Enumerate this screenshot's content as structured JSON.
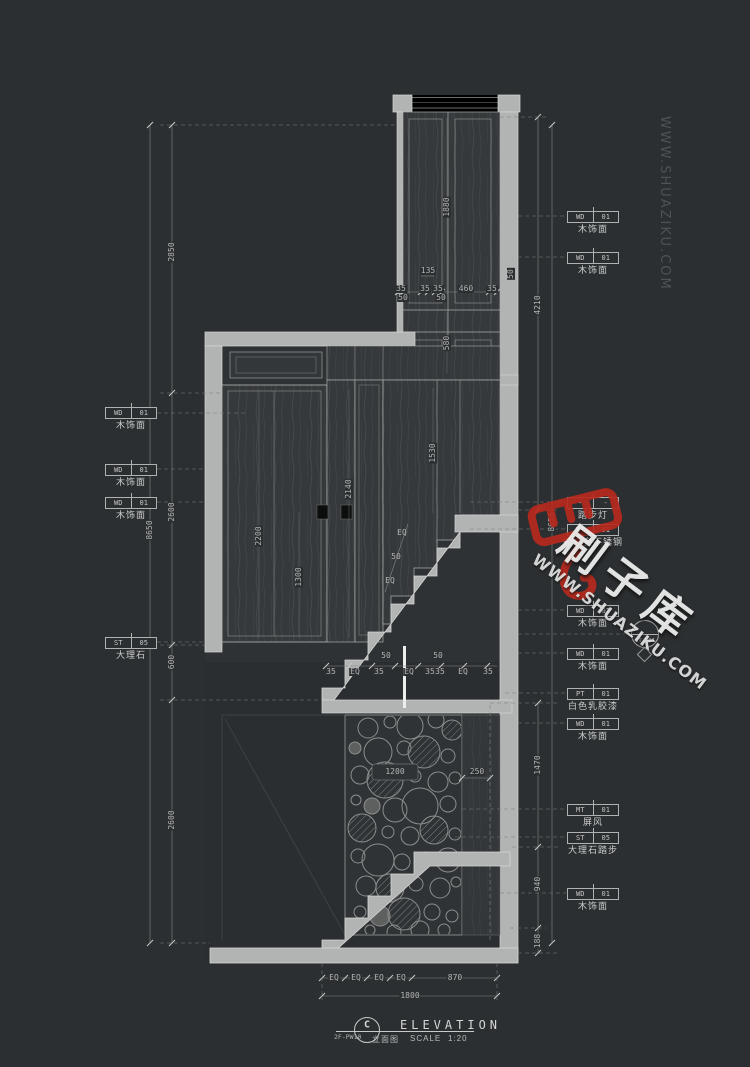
{
  "watermark": {
    "brand": "刷子库",
    "site": "WWW.SHUAZIKU.COM"
  },
  "title_block": {
    "detail_letter": "C",
    "detail_code": "2F-PW10",
    "title_en": "ELEVATION",
    "title_cn": "立面图",
    "scale_label": "SCALE",
    "scale_value": "1:20"
  },
  "dims": {
    "v2850": "2850",
    "v2600": "2600",
    "v600": "600",
    "v8650": "8650",
    "v4210": "4210",
    "v1470": "1470",
    "v940": "940",
    "v188": "188",
    "v1880": "1880",
    "v580": "580",
    "v135": "135",
    "v460": "460",
    "v1530": "1530",
    "v2140": "2140",
    "v2200": "2200",
    "v1300": "1300",
    "v1200": "1200",
    "v250": "250",
    "v870": "870",
    "v1800": "1800",
    "v50": "50",
    "v35": "35",
    "eq": "EQ"
  },
  "callouts": {
    "left": [
      {
        "code": "WD",
        "num": "01",
        "desc": "木饰面"
      },
      {
        "code": "WD",
        "num": "01",
        "desc": "木饰面"
      },
      {
        "code": "WD",
        "num": "01",
        "desc": "木饰面"
      },
      {
        "code": "ST",
        "num": "05",
        "desc": "大理石"
      }
    ],
    "right": [
      {
        "code": "WD",
        "num": "01",
        "desc": "木饰面"
      },
      {
        "code": "WD",
        "num": "01",
        "desc": "木饰面"
      },
      {
        "code": "-",
        "num": "-",
        "desc": "踏步灯"
      },
      {
        "code": "MT",
        "num": "01",
        "desc": "香槟金不锈钢"
      },
      {
        "code": "WD",
        "num": "01",
        "desc": "木饰面"
      },
      {
        "code": "WD",
        "num": "01",
        "desc": "木饰面"
      },
      {
        "code": "PT",
        "num": "01",
        "desc": "白色乳胶漆"
      },
      {
        "code": "WD",
        "num": "01",
        "desc": "木饰面"
      },
      {
        "code": "MT",
        "num": "01",
        "desc": "屏风"
      },
      {
        "code": "ST",
        "num": "05",
        "desc": "大理石踏步"
      },
      {
        "code": "WD",
        "num": "01",
        "desc": "木饰面"
      }
    ],
    "light_tag": "LT-P01"
  }
}
